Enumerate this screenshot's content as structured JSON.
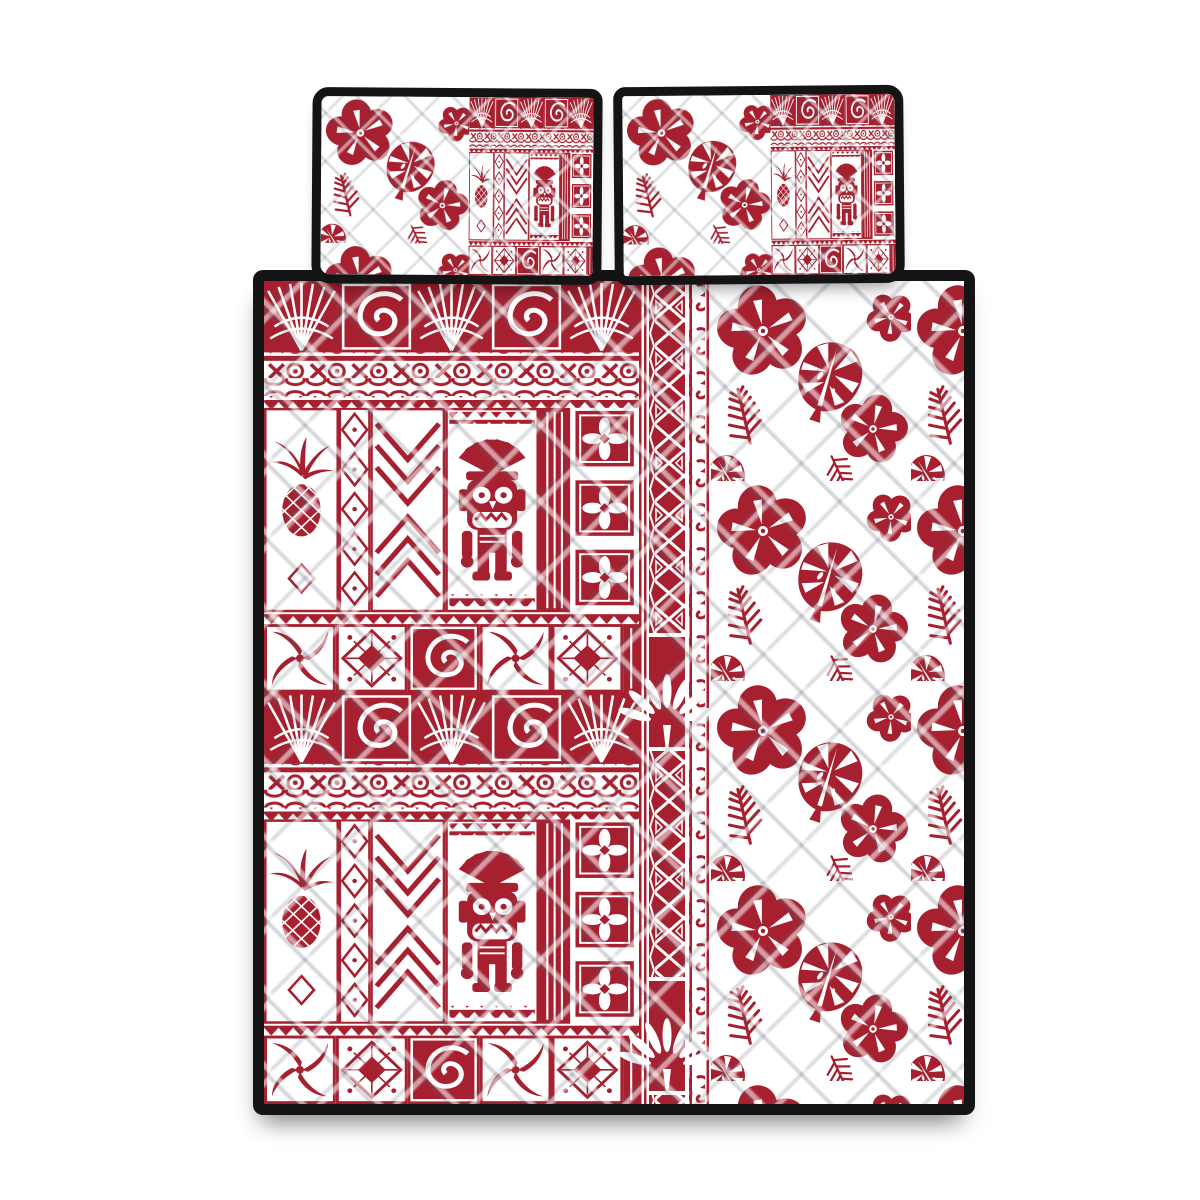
{
  "meta": {
    "type": "product-photo",
    "subject": "Hawaiian quilt bed set: red-on-white Polynesian tapa tribal patchwork with tiki, pineapple and spiral motifs, tribal lattice border band, and hibiscus flower quilted panel, with two matching pillow shams with black piping",
    "stage_aria": "Hawaiian tribal quilt bedding set product image"
  },
  "colors": {
    "background": "#ffffff",
    "red": "#a6202f",
    "red_deep": "#8e1424",
    "black": "#141414"
  },
  "pillows": {
    "left": {
      "aria": "Pillow sham with hibiscus print on left half and tapa tribal patchwork on right half, black piping"
    },
    "right": {
      "aria": "Pillow sham with hibiscus print on left half and tapa tribal patchwork on right half, black piping"
    }
  },
  "quilt": {
    "aria": "Quilt with tapa patchwork left panel, vertical tribal band, and hibiscus field right panel, black binding",
    "panels": {
      "tapa": {
        "motifs": [
          "tiki figure",
          "pineapple",
          "white spiral on red",
          "fan rays",
          "quatrefoil tiles",
          "X-and-O border",
          "chain link border",
          "sawtooth border",
          "nested zigzag chevrons",
          "diamond burst tile",
          "cross leaf tile",
          "diamond column",
          "stripe column"
        ]
      },
      "band": {
        "motifs": [
          "red pinstripes",
          "triangle lattice stripe",
          "white zigzag edge",
          "koru wave column",
          "white fan-leaf ornament"
        ]
      },
      "hibiscus": {
        "motifs": [
          "hibiscus flower",
          "monstera leaf",
          "fern frond",
          "diagonal quilted diamonds"
        ]
      }
    }
  }
}
